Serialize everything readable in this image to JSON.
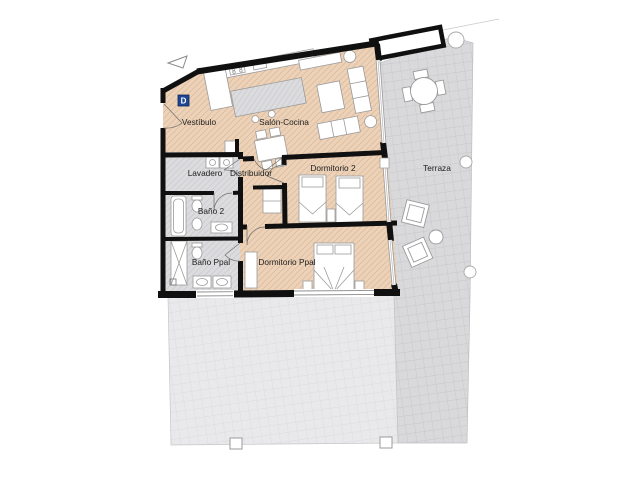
{
  "plan": {
    "unit_label": "D",
    "rooms": {
      "vestibulo": "Vestíbulo",
      "salon_cocina": "Salón-Cocina",
      "lavadero": "Lavadero",
      "distribuidor": "Distribuidor",
      "dormitorio2": "Dormitorio 2",
      "bano2": "Baño 2",
      "bano_ppal": "Baño Ppal",
      "dormitorio_ppal": "Dormitorio Ppal",
      "terraza": "Terraza"
    },
    "colors": {
      "floor_tan": "#ecd2b8",
      "floor_wet_gray": "#dcdcde",
      "terrace_paving_dark": "#d9d9db",
      "terrace_paving_light": "#e9e9eb",
      "wall_black": "#101010",
      "unit_badge_blue": "#1f4694"
    }
  }
}
